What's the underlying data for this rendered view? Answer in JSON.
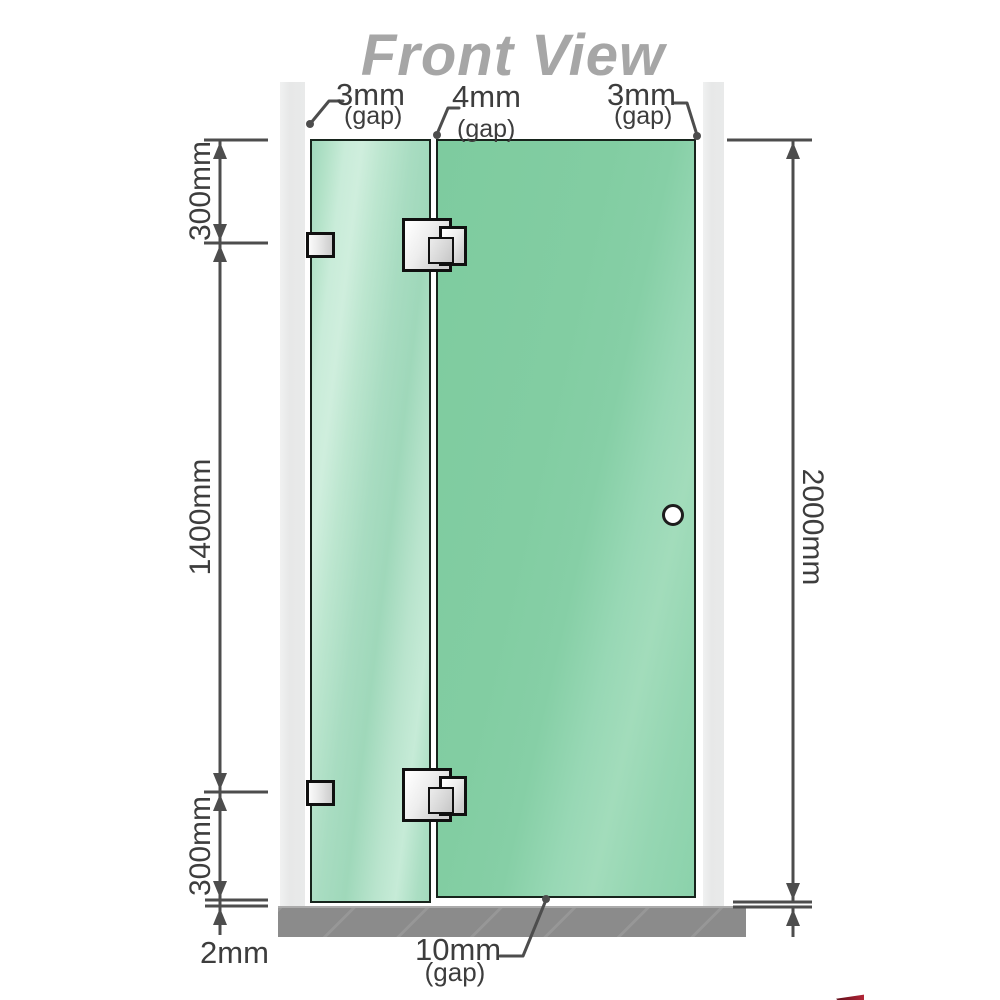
{
  "title": "Front View",
  "dimensions": {
    "top_gaps": [
      {
        "value": "3mm",
        "unit": "(gap)"
      },
      {
        "value": "4mm",
        "unit": "(gap)"
      },
      {
        "value": "3mm",
        "unit": "(gap)"
      }
    ],
    "left_heights": {
      "top": "300mm",
      "middle": "1400mm",
      "bottom": "300mm"
    },
    "total_height": "2000mm",
    "floor_clearance": "2mm",
    "bottom_gap": {
      "value": "10mm",
      "unit": "(gap)"
    }
  },
  "colors": {
    "title_gray": "#a6a6a6",
    "dimension_line": "#4d4d4d",
    "dimension_text": "#3d3d3d",
    "glass_left": "#b9e4cd",
    "glass_right": "#84cfa5",
    "glass_border": "#17241c",
    "wall_gray": "#e9eaea",
    "floor_gray": "#8b8b8b",
    "hardware_silver": "#e0e0e0"
  }
}
